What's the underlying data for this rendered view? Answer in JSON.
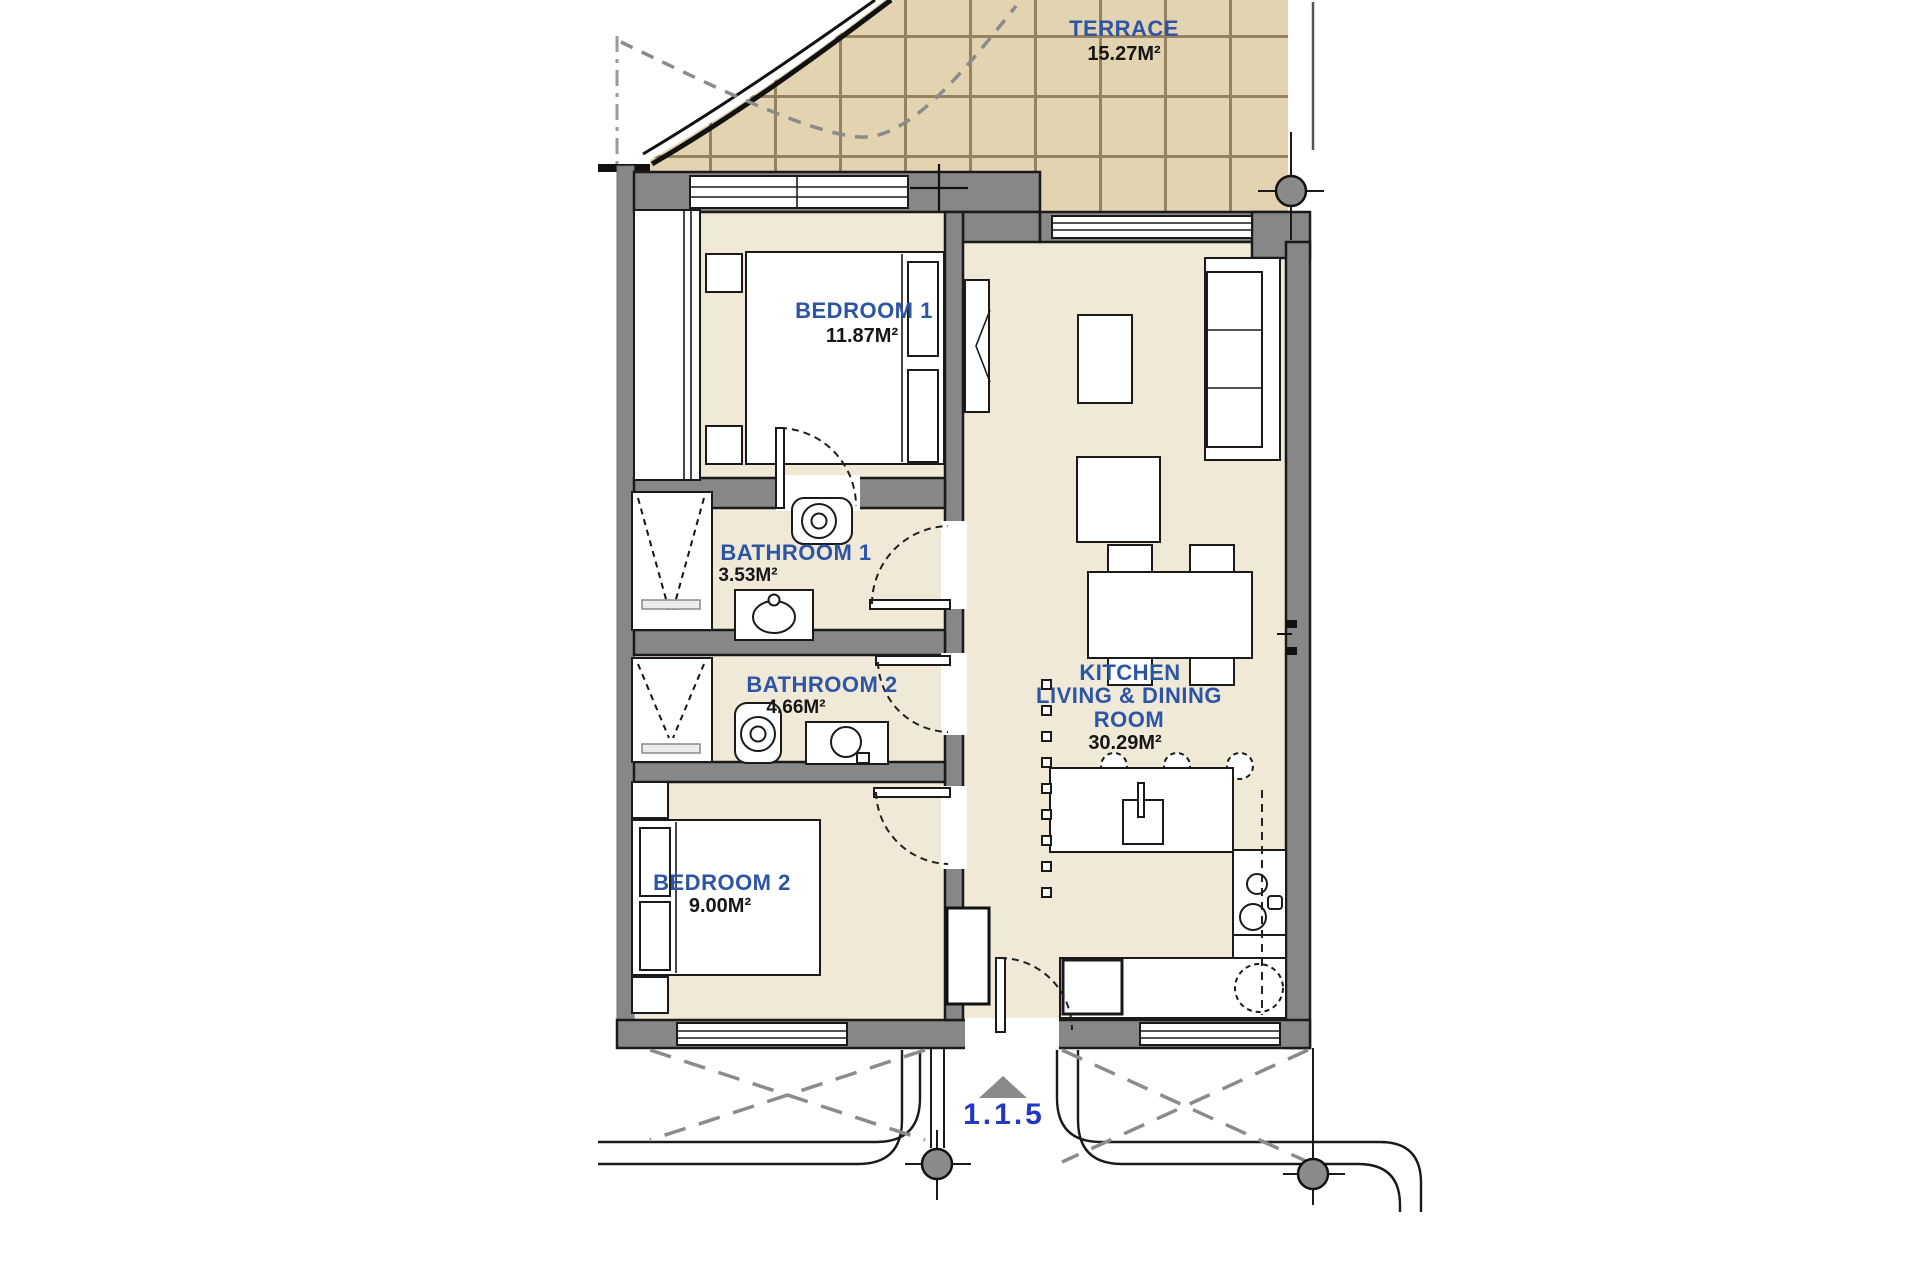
{
  "rooms": {
    "terrace": {
      "name": "TERRACE",
      "area": "15.27M²"
    },
    "bedroom1": {
      "name": "BEDROOM 1",
      "area": "11.87M²"
    },
    "bathroom1": {
      "name": "BATHROOM 1",
      "area": "3.53M²"
    },
    "bathroom2": {
      "name": "BATHROOM 2",
      "area": "4.66M²"
    },
    "bedroom2": {
      "name": "BEDROOM 2",
      "area": "9.00M²"
    },
    "kitchen_living_dining": {
      "line1": "KITCHEN",
      "line2": "LIVING & DINING",
      "line3": "ROOM",
      "area": "30.29M²"
    }
  },
  "unit": {
    "label": "1.1.5"
  },
  "colors": {
    "terrace_tile": "#e2d3b1",
    "tile_grid": "#96825f",
    "floor": "#f0e9d7",
    "wall": "#878787",
    "room_label": "#2d55a5",
    "area_label": "#161616",
    "unit_label": "#2337c5",
    "site_gray": "#8a8a8a"
  }
}
